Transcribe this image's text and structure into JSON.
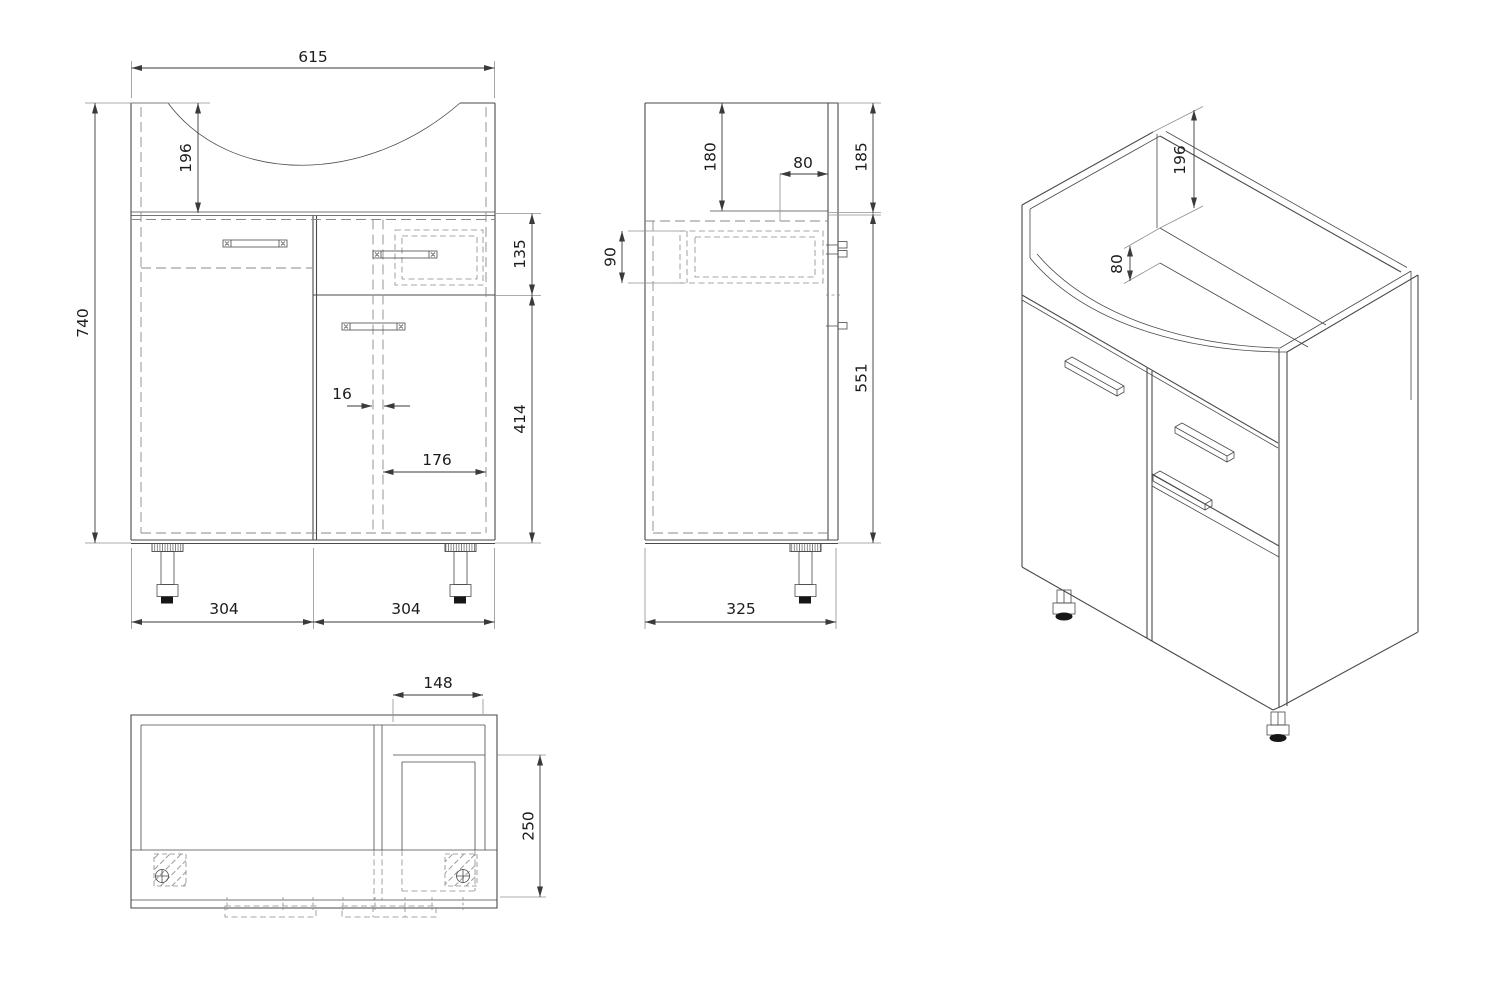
{
  "colors": {
    "background": "#ffffff",
    "line": "#4a4a4a",
    "hidden": "#8a8a8a",
    "ext": "#909090",
    "dim": "#3a3a3a",
    "text": "#1c1c1c",
    "pad": "#161616"
  },
  "views": {
    "front": {
      "dims": {
        "overall_width": "615",
        "basin_recess_height": "196",
        "overall_height": "740",
        "drawer_front_height": "135",
        "door_height": "414",
        "partition_thickness": "16",
        "right_compartment_width": "176",
        "left_module_width": "304",
        "right_module_width": "304"
      }
    },
    "side": {
      "dims": {
        "top_depth": "180",
        "back_rail_depth": "80",
        "top_section_height": "185",
        "drawer_box_height": "90",
        "lower_body_height": "551",
        "overall_depth": "325"
      }
    },
    "plan": {
      "dims": {
        "drawer_bay_width": "148",
        "drawer_bay_depth": "250"
      }
    },
    "iso": {
      "dims": {
        "side_panel_rise": "196",
        "back_rail_height": "80"
      }
    }
  }
}
